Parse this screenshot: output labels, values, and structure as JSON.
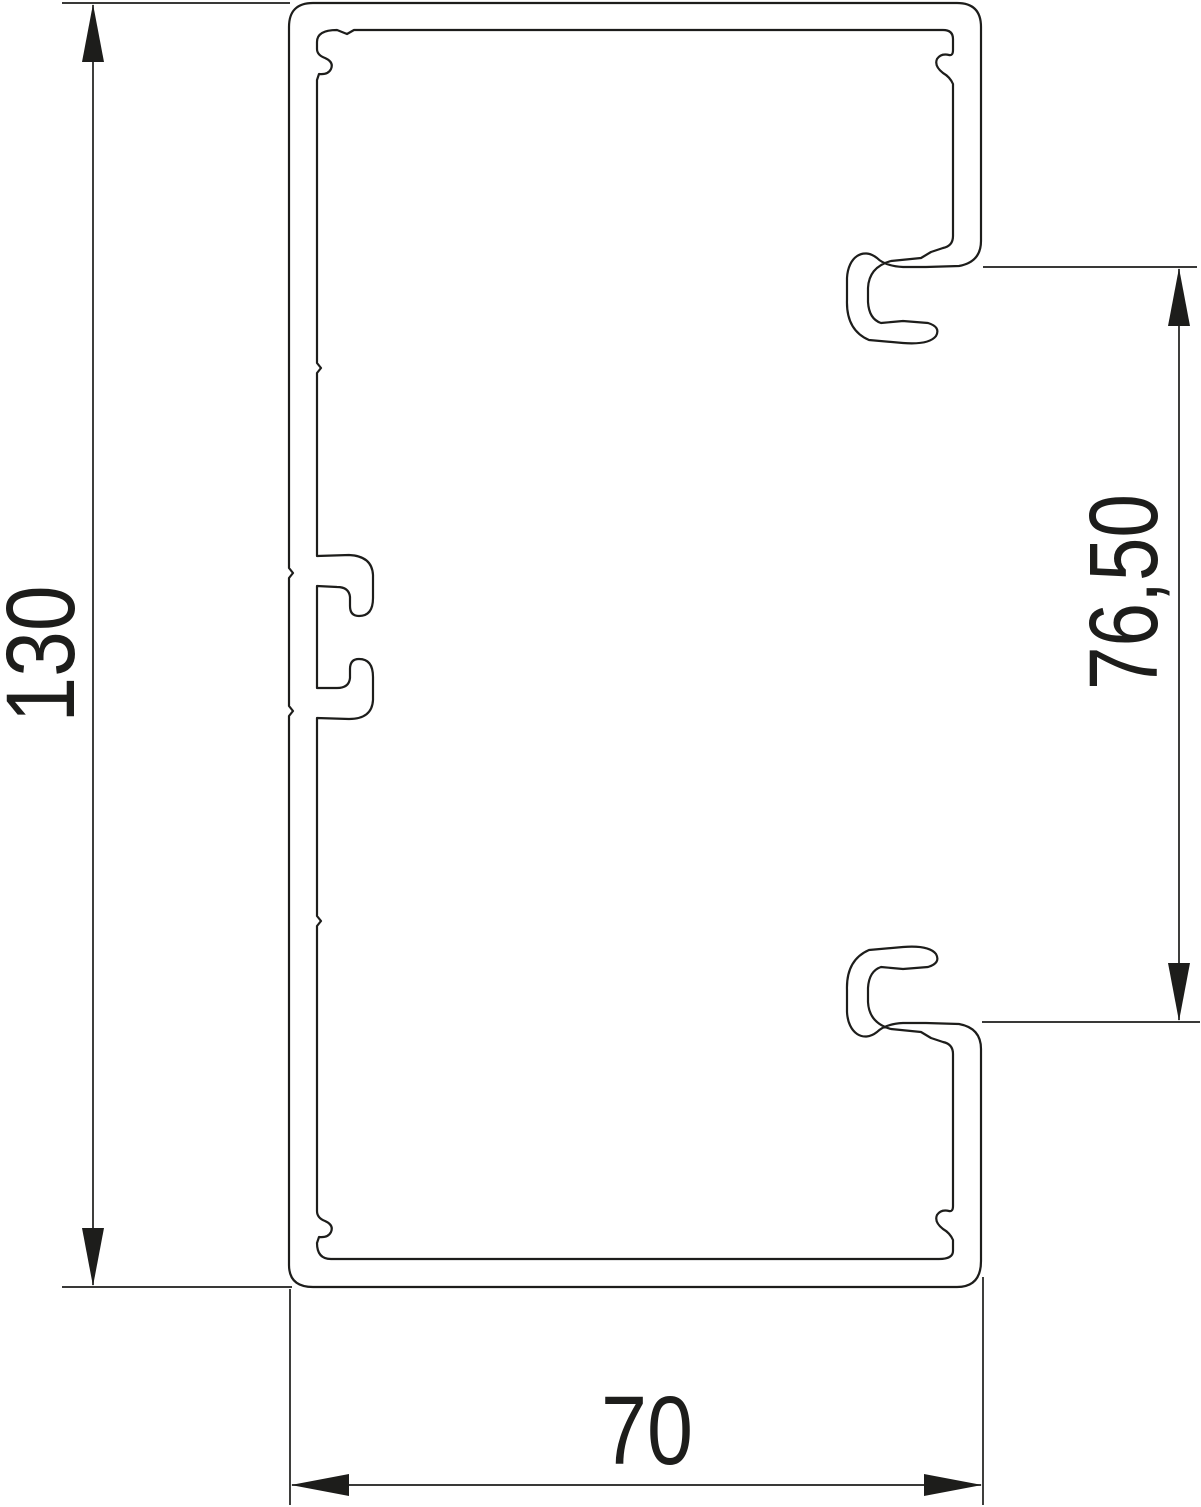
{
  "drawing": {
    "figure": "cable-trunking-profile-cross-section",
    "background_color": "#ffffff",
    "line_color": "#1d1d1b",
    "dimensions": {
      "overall_height": {
        "label": "130"
      },
      "front_opening": {
        "label": "76,50"
      },
      "overall_width": {
        "label": "70"
      }
    }
  }
}
